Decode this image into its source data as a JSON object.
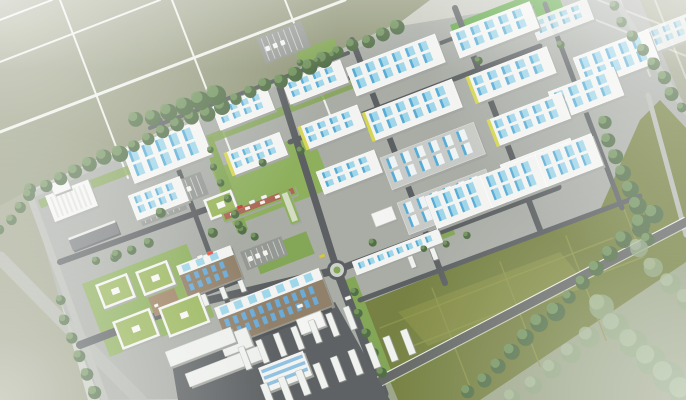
{
  "image": {
    "alt": "Aerial architectural rendering of a master-planned industrial logistics park with rows of white warehouses with blue skylights, office campus, truck yards, green reserve field and surrounding farmland",
    "width": 686,
    "height": 400
  },
  "palette": {
    "bg": "#c6c9bd",
    "farm": "#8d9374",
    "farm_light": "#a6ab93",
    "park_ground": "#a5a9a2",
    "road_outer": "#b3b6af",
    "road_inner": "#54585a",
    "road_se": "#5e625f",
    "road_line": "#eef0ea",
    "roof_white": "#f3f4f1",
    "roof_grey": "#c5c8c3",
    "wall_shadow": "#9fa29c",
    "skylight_blue": "#9bd4e8",
    "skylight_blue_dark": "#4fa8d4",
    "skylight_white": "#eef3f4",
    "accent_yellow": "#d3d44c",
    "green_verge": "#7ea24e",
    "green_campus": "#88ac55",
    "green_bright": "#57a33c",
    "field_olive": "#6f7b39",
    "field_line": "#8a9346",
    "field_tint": "#8a9142",
    "tree_dark": "#4a683e",
    "tree_light": "#70925a",
    "tree_far": "#8ba37a",
    "tree_far_light": "#a4b894",
    "brown_wall": "#8d7b63",
    "window_blue": "#64a7d8",
    "dock_dark": "#4c5052",
    "truck_white": "#f0f2ef",
    "courtyard_brown": "#9b7f60",
    "admin_red": "#a8604e",
    "lot_grey": "#90948f",
    "glass_blue": "#79b5dd"
  },
  "scene": {
    "angle": -21,
    "farm_polys": [
      {
        "pts": [
          [
            0,
            0
          ],
          [
            430,
            0
          ],
          [
            398,
            24
          ],
          [
            30,
            190
          ],
          [
            0,
            206
          ]
        ],
        "c": "farm",
        "o": 1
      },
      {
        "pts": [
          [
            0,
            206
          ],
          [
            30,
            190
          ],
          [
            60,
            300
          ],
          [
            88,
            400
          ],
          [
            0,
            400
          ]
        ],
        "c": "farm",
        "o": 0.8
      },
      {
        "pts": [
          [
            600,
            0
          ],
          [
            686,
            0
          ],
          [
            686,
            115
          ]
        ],
        "c": "farm",
        "o": 0.85
      }
    ],
    "park_ground": [
      [
        30,
        196
      ],
      [
        400,
        26
      ],
      [
        560,
        0
      ],
      [
        640,
        0
      ],
      [
        686,
        110
      ],
      [
        686,
        245
      ],
      [
        352,
        398
      ],
      [
        100,
        400
      ],
      [
        60,
        300
      ]
    ],
    "outside_se": [
      [
        352,
        400
      ],
      [
        686,
        226
      ],
      [
        686,
        400
      ]
    ],
    "farm_grid": [
      {
        "x1": 0,
        "y1": 20,
        "x2": 52,
        "y2": 0,
        "w": 2
      },
      {
        "x1": 0,
        "y1": 62,
        "x2": 160,
        "y2": 0,
        "w": 2
      },
      {
        "x1": 0,
        "y1": 132,
        "x2": 345,
        "y2": 0,
        "w": 3
      },
      {
        "x1": 60,
        "y1": 0,
        "x2": 128,
        "y2": 178,
        "w": 2
      },
      {
        "x1": 172,
        "y1": 0,
        "x2": 232,
        "y2": 155,
        "w": 2
      },
      {
        "x1": 285,
        "y1": 0,
        "x2": 335,
        "y2": 128,
        "w": 2
      },
      {
        "x1": 598,
        "y1": 0,
        "x2": 686,
        "y2": 34,
        "w": 2,
        "o": 0.5
      },
      {
        "x1": 576,
        "y1": 12,
        "x2": 686,
        "y2": 56,
        "w": 2,
        "o": 0.5
      },
      {
        "x1": 655,
        "y1": 0,
        "x2": 686,
        "y2": 78,
        "w": 2,
        "o": 0.5
      },
      {
        "x1": 620,
        "y1": 0,
        "x2": 650,
        "y2": 76,
        "w": 2,
        "o": 0.5
      }
    ],
    "field": {
      "poly": [
        [
          358,
          305
        ],
        [
          600,
          210
        ],
        [
          640,
          120
        ],
        [
          660,
          100
        ],
        [
          686,
          128
        ],
        [
          686,
          262
        ],
        [
          480,
          400
        ],
        [
          398,
          400
        ]
      ],
      "tint": [
        [
          398,
          312
        ],
        [
          560,
          252
        ],
        [
          588,
          286
        ],
        [
          428,
          346
        ]
      ],
      "lines": [
        {
          "x1": 380,
          "y1": 328,
          "x2": 613,
          "y2": 238
        },
        {
          "x1": 410,
          "y1": 347,
          "x2": 643,
          "y2": 257
        },
        {
          "x1": 432,
          "y1": 288,
          "x2": 472,
          "y2": 392
        },
        {
          "x1": 500,
          "y1": 262,
          "x2": 540,
          "y2": 366
        },
        {
          "x1": 566,
          "y1": 236,
          "x2": 606,
          "y2": 340
        },
        {
          "x1": 598,
          "y1": 142,
          "x2": 636,
          "y2": 240
        }
      ]
    },
    "greens": [
      {
        "x": 82,
        "y": 284,
        "w": 112,
        "h": 78,
        "c": "green_campus"
      },
      {
        "x": 212,
        "y": 170,
        "w": 106,
        "h": 60,
        "c": "green_campus"
      },
      {
        "x": 340,
        "y": 282,
        "w": 16,
        "h": 112,
        "c": "green_verge"
      },
      {
        "x": 252,
        "y": 252,
        "w": 58,
        "h": 24,
        "c": "green_verge"
      },
      {
        "x": 450,
        "y": 25,
        "w": 112,
        "h": 30,
        "c": "green_bright"
      },
      {
        "x": 296,
        "y": 52,
        "w": 40,
        "h": 20,
        "c": "green_verge"
      },
      {
        "x": 392,
        "y": 248,
        "w": 64,
        "h": 10,
        "c": "green_verge"
      },
      {
        "x": 38,
        "y": 200,
        "w": 362,
        "h": 9,
        "c": "green_verge",
        "o": 0.85
      },
      {
        "x": 202,
        "y": 140,
        "w": 11,
        "h": 100,
        "c": "green_verge"
      }
    ],
    "roads_outer": [
      {
        "x1": 30,
        "y1": 196,
        "x2": 396,
        "y2": 27,
        "w": 6
      },
      {
        "x1": 617,
        "y1": 2,
        "x2": 686,
        "y2": 112,
        "w": 6
      },
      {
        "x1": 648,
        "y1": 95,
        "x2": 686,
        "y2": 235,
        "w": 5
      },
      {
        "x1": 0,
        "y1": 258,
        "x2": 140,
        "y2": 400,
        "w": 13,
        "o": 0.8
      },
      {
        "x1": 30,
        "y1": 196,
        "x2": 105,
        "y2": 400,
        "w": 7
      }
    ],
    "roads_inner": [
      {
        "x1": 80,
        "y1": 345,
        "x2": 180,
        "y2": 307,
        "w": 8
      },
      {
        "x1": 180,
        "y1": 307,
        "x2": 337,
        "y2": 270,
        "w": 8
      },
      {
        "x1": 280,
        "y1": 88,
        "x2": 337,
        "y2": 270,
        "w": 7
      },
      {
        "x1": 337,
        "y1": 270,
        "x2": 384,
        "y2": 394,
        "w": 9
      },
      {
        "x1": 352,
        "y1": 40,
        "x2": 445,
        "y2": 283,
        "w": 6
      },
      {
        "x1": 455,
        "y1": 8,
        "x2": 540,
        "y2": 230,
        "w": 6
      },
      {
        "x1": 545,
        "y1": 4,
        "x2": 622,
        "y2": 208,
        "w": 5
      },
      {
        "x1": 290,
        "y1": 142,
        "x2": 540,
        "y2": 46,
        "w": 5
      },
      {
        "x1": 300,
        "y1": 97,
        "x2": 532,
        "y2": 8,
        "w": 4
      },
      {
        "x1": 60,
        "y1": 262,
        "x2": 210,
        "y2": 208,
        "w": 6
      },
      {
        "x1": 160,
        "y1": 120,
        "x2": 238,
        "y2": 330,
        "w": 5
      },
      {
        "x1": 238,
        "y1": 330,
        "x2": 252,
        "y2": 400,
        "w": 6
      },
      {
        "x1": 150,
        "y1": 128,
        "x2": 348,
        "y2": 53,
        "w": 4
      },
      {
        "x1": 360,
        "y1": 300,
        "x2": 640,
        "y2": 196,
        "w": 5
      },
      {
        "x1": 337,
        "y1": 270,
        "x2": 558,
        "y2": 187,
        "w": 7
      }
    ],
    "boundary_se": {
      "x1": 348,
      "y1": 398,
      "x2": 686,
      "y2": 222,
      "w": 9
    },
    "roundabout": {
      "x": 337,
      "y": 270,
      "r": 10
    },
    "truck_yard": [
      [
        170,
        352
      ],
      [
        228,
        342
      ],
      [
        335,
        302
      ],
      [
        390,
        400
      ],
      [
        178,
        400
      ]
    ],
    "parking_lots": [
      {
        "x": 256,
        "y": 38,
        "w": 48,
        "h": 28
      },
      {
        "x": 163,
        "y": 186,
        "w": 40,
        "h": 24
      },
      {
        "x": 134,
        "y": 204,
        "w": 48,
        "h": 24
      },
      {
        "x": 240,
        "y": 252,
        "w": 44,
        "h": 20
      }
    ],
    "buildings": [
      {
        "t": "ware",
        "x": 530,
        "y": 20,
        "w": 60,
        "h": 22,
        "c": 4,
        "o": 0.9
      },
      {
        "t": "ware",
        "x": 645,
        "y": 30,
        "w": 58,
        "h": 24,
        "c": 4,
        "o": 0.85
      },
      {
        "t": "ware",
        "x": 573,
        "y": 58,
        "w": 80,
        "h": 34,
        "c": 5
      },
      {
        "t": "ware",
        "x": 450,
        "y": 32,
        "w": 85,
        "h": 28,
        "c": 5
      },
      {
        "t": "ware",
        "x": 346,
        "y": 68,
        "w": 95,
        "h": 30,
        "c": 6
      },
      {
        "t": "ware",
        "x": 282,
        "y": 82,
        "w": 62,
        "h": 24,
        "c": 4
      },
      {
        "t": "ware",
        "x": 467,
        "y": 77,
        "w": 85,
        "h": 28,
        "c": 5,
        "ac": 1
      },
      {
        "t": "ware",
        "x": 363,
        "y": 113,
        "w": 95,
        "h": 30,
        "c": 6,
        "ac": 1
      },
      {
        "t": "ware",
        "x": 212,
        "y": 108,
        "w": 58,
        "h": 24,
        "c": 4
      },
      {
        "t": "ware",
        "x": 299,
        "y": 127,
        "w": 62,
        "h": 24,
        "c": 4,
        "ac": 1
      },
      {
        "t": "ware",
        "x": 548,
        "y": 92,
        "w": 70,
        "h": 30,
        "c": 4
      },
      {
        "t": "ware",
        "x": 488,
        "y": 120,
        "w": 78,
        "h": 28,
        "c": 5,
        "ac": 1
      },
      {
        "t": "grey",
        "x": 380,
        "y": 158,
        "w": 100,
        "h": 34,
        "c": 6
      },
      {
        "t": "ware",
        "x": 225,
        "y": 153,
        "w": 58,
        "h": 24,
        "c": 4,
        "ac": 1
      },
      {
        "t": "ware",
        "x": 316,
        "y": 172,
        "w": 62,
        "h": 24,
        "c": 4
      },
      {
        "t": "grey",
        "x": 397,
        "y": 203,
        "w": 95,
        "h": 34,
        "c": 6
      },
      {
        "t": "ware",
        "x": 500,
        "y": 165,
        "w": 75,
        "h": 28,
        "c": 5
      },
      {
        "t": "ware",
        "x": 122,
        "y": 150,
        "w": 82,
        "h": 36,
        "c": 5
      },
      {
        "t": "ware",
        "x": 128,
        "y": 196,
        "w": 55,
        "h": 26,
        "c": 4
      },
      {
        "t": "factory",
        "x": 45,
        "y": 196,
        "w": 46,
        "h": 28
      },
      {
        "t": "box",
        "x": 50,
        "y": 184,
        "w": 18,
        "h": 12
      },
      {
        "t": "slabdark",
        "x": 68,
        "y": 238,
        "w": 50,
        "h": 14
      },
      {
        "t": "greenroof",
        "x": 203,
        "y": 200,
        "w": 30,
        "h": 22
      },
      {
        "t": "admin",
        "x": 221,
        "y": 213,
        "w": 78,
        "h": 10
      },
      {
        "t": "adminwing",
        "x": 279,
        "y": 193,
        "w": 10,
        "h": 34
      },
      {
        "t": "ware",
        "x": 425,
        "y": 197,
        "w": 60,
        "h": 34,
        "c": 4
      },
      {
        "t": "ware",
        "x": 480,
        "y": 176,
        "w": 60,
        "h": 34,
        "c": 4
      },
      {
        "t": "ware",
        "x": 535,
        "y": 155,
        "w": 60,
        "h": 34,
        "c": 4
      },
      {
        "t": "box",
        "x": 371,
        "y": 214,
        "w": 22,
        "h": 14
      },
      {
        "t": "narrow",
        "x": 352,
        "y": 262,
        "w": 92,
        "h": 14,
        "c": 8
      },
      {
        "t": "multi",
        "x": 176,
        "y": 266,
        "w": 58,
        "h": 34
      },
      {
        "t": "greenroof",
        "x": 95,
        "y": 285,
        "w": 34,
        "h": 26
      },
      {
        "t": "greenroof",
        "x": 135,
        "y": 272,
        "w": 34,
        "h": 26
      },
      {
        "t": "court",
        "x": 148,
        "y": 298,
        "w": 28,
        "h": 20
      },
      {
        "t": "greenroof",
        "x": 112,
        "y": 322,
        "w": 40,
        "h": 30
      },
      {
        "t": "greenroof",
        "x": 158,
        "y": 308,
        "w": 44,
        "h": 32
      },
      {
        "t": "multi",
        "x": 214,
        "y": 308,
        "w": 112,
        "h": 40
      },
      {
        "t": "box",
        "x": 296,
        "y": 320,
        "w": 26,
        "h": 16
      },
      {
        "t": "slab",
        "x": 218,
        "y": 338,
        "w": 30,
        "h": 20
      },
      {
        "t": "slab",
        "x": 165,
        "y": 352,
        "w": 70,
        "h": 16
      },
      {
        "t": "slab",
        "x": 185,
        "y": 374,
        "w": 78,
        "h": 14
      },
      {
        "t": "glass",
        "x": 258,
        "y": 368,
        "w": 48,
        "h": 26
      }
    ],
    "tree_rows": [
      {
        "x1": 30,
        "y1": 190,
        "x2": 396,
        "y2": 26,
        "n": 26,
        "r": 7
      },
      {
        "x1": 0,
        "y1": 230,
        "x2": 28,
        "y2": 194,
        "n": 4,
        "r": 6
      },
      {
        "x1": 135,
        "y1": 120,
        "x2": 215,
        "y2": 95,
        "n": 6,
        "r": 9
      },
      {
        "x1": 612,
        "y1": 6,
        "x2": 682,
        "y2": 106,
        "n": 8,
        "r": 6
      },
      {
        "x1": 468,
        "y1": 392,
        "x2": 652,
        "y2": 212,
        "n": 14,
        "r": 8
      },
      {
        "x1": 602,
        "y1": 122,
        "x2": 648,
        "y2": 238,
        "n": 8,
        "r": 8
      },
      {
        "x1": 598,
        "y1": 306,
        "x2": 682,
        "y2": 392,
        "n": 6,
        "r": 15,
        "c": "far",
        "o": 0.85
      },
      {
        "x1": 636,
        "y1": 248,
        "x2": 686,
        "y2": 298,
        "n": 4,
        "r": 11,
        "c": "far",
        "o": 0.8
      },
      {
        "x1": 512,
        "y1": 398,
        "x2": 588,
        "y2": 336,
        "n": 5,
        "r": 10,
        "c": "far",
        "o": 0.8
      },
      {
        "x1": 352,
        "y1": 292,
        "x2": 380,
        "y2": 372,
        "n": 5,
        "r": 5
      },
      {
        "x1": 58,
        "y1": 300,
        "x2": 92,
        "y2": 392,
        "n": 6,
        "r": 6
      },
      {
        "x1": 96,
        "y1": 262,
        "x2": 148,
        "y2": 242,
        "n": 4,
        "r": 5
      },
      {
        "x1": 424,
        "y1": 250,
        "x2": 466,
        "y2": 234,
        "n": 3,
        "r": 4
      },
      {
        "x1": 300,
        "y1": 64,
        "x2": 332,
        "y2": 54,
        "n": 3,
        "r": 4
      },
      {
        "x1": 208,
        "y1": 150,
        "x2": 240,
        "y2": 230,
        "n": 6,
        "r": 4
      }
    ],
    "trees": [
      {
        "x": 212,
        "y": 232,
        "r": 5
      },
      {
        "x": 238,
        "y": 224,
        "r": 4
      },
      {
        "x": 254,
        "y": 236,
        "r": 4
      },
      {
        "x": 300,
        "y": 150,
        "r": 4
      },
      {
        "x": 262,
        "y": 162,
        "r": 4
      },
      {
        "x": 372,
        "y": 242,
        "r": 4
      },
      {
        "x": 160,
        "y": 212,
        "r": 5
      },
      {
        "x": 116,
        "y": 254,
        "r": 5
      },
      {
        "x": 478,
        "y": 60,
        "r": 4
      },
      {
        "x": 560,
        "y": 44,
        "r": 4
      }
    ],
    "truck_rows": [
      {
        "x1": 245,
        "y1": 358,
        "x2": 350,
        "y2": 318,
        "n": 7,
        "w": 6,
        "l": 24
      },
      {
        "x1": 268,
        "y1": 396,
        "x2": 408,
        "y2": 342,
        "n": 9,
        "w": 7,
        "l": 26
      },
      {
        "x1": 205,
        "y1": 300,
        "x2": 242,
        "y2": 286,
        "n": 3,
        "w": 5,
        "l": 12
      },
      {
        "x1": 412,
        "y1": 262,
        "x2": 434,
        "y2": 254,
        "n": 2,
        "w": 5,
        "l": 12
      }
    ],
    "cars": [
      {
        "x": 322,
        "y": 256,
        "c": "#d6c23c"
      },
      {
        "x": 300,
        "y": 306,
        "c": "#f2f3f0"
      },
      {
        "x": 348,
        "y": 298,
        "c": "#f2f3f0"
      },
      {
        "x": 240,
        "y": 207,
        "c": "#c0392b"
      },
      {
        "x": 252,
        "y": 202,
        "c": "#f2f3f0"
      },
      {
        "x": 264,
        "y": 197,
        "c": "#f2f3f0"
      },
      {
        "x": 200,
        "y": 257,
        "c": "#f2f3f0"
      },
      {
        "x": 210,
        "y": 253,
        "c": "#e74c3c"
      }
    ]
  }
}
